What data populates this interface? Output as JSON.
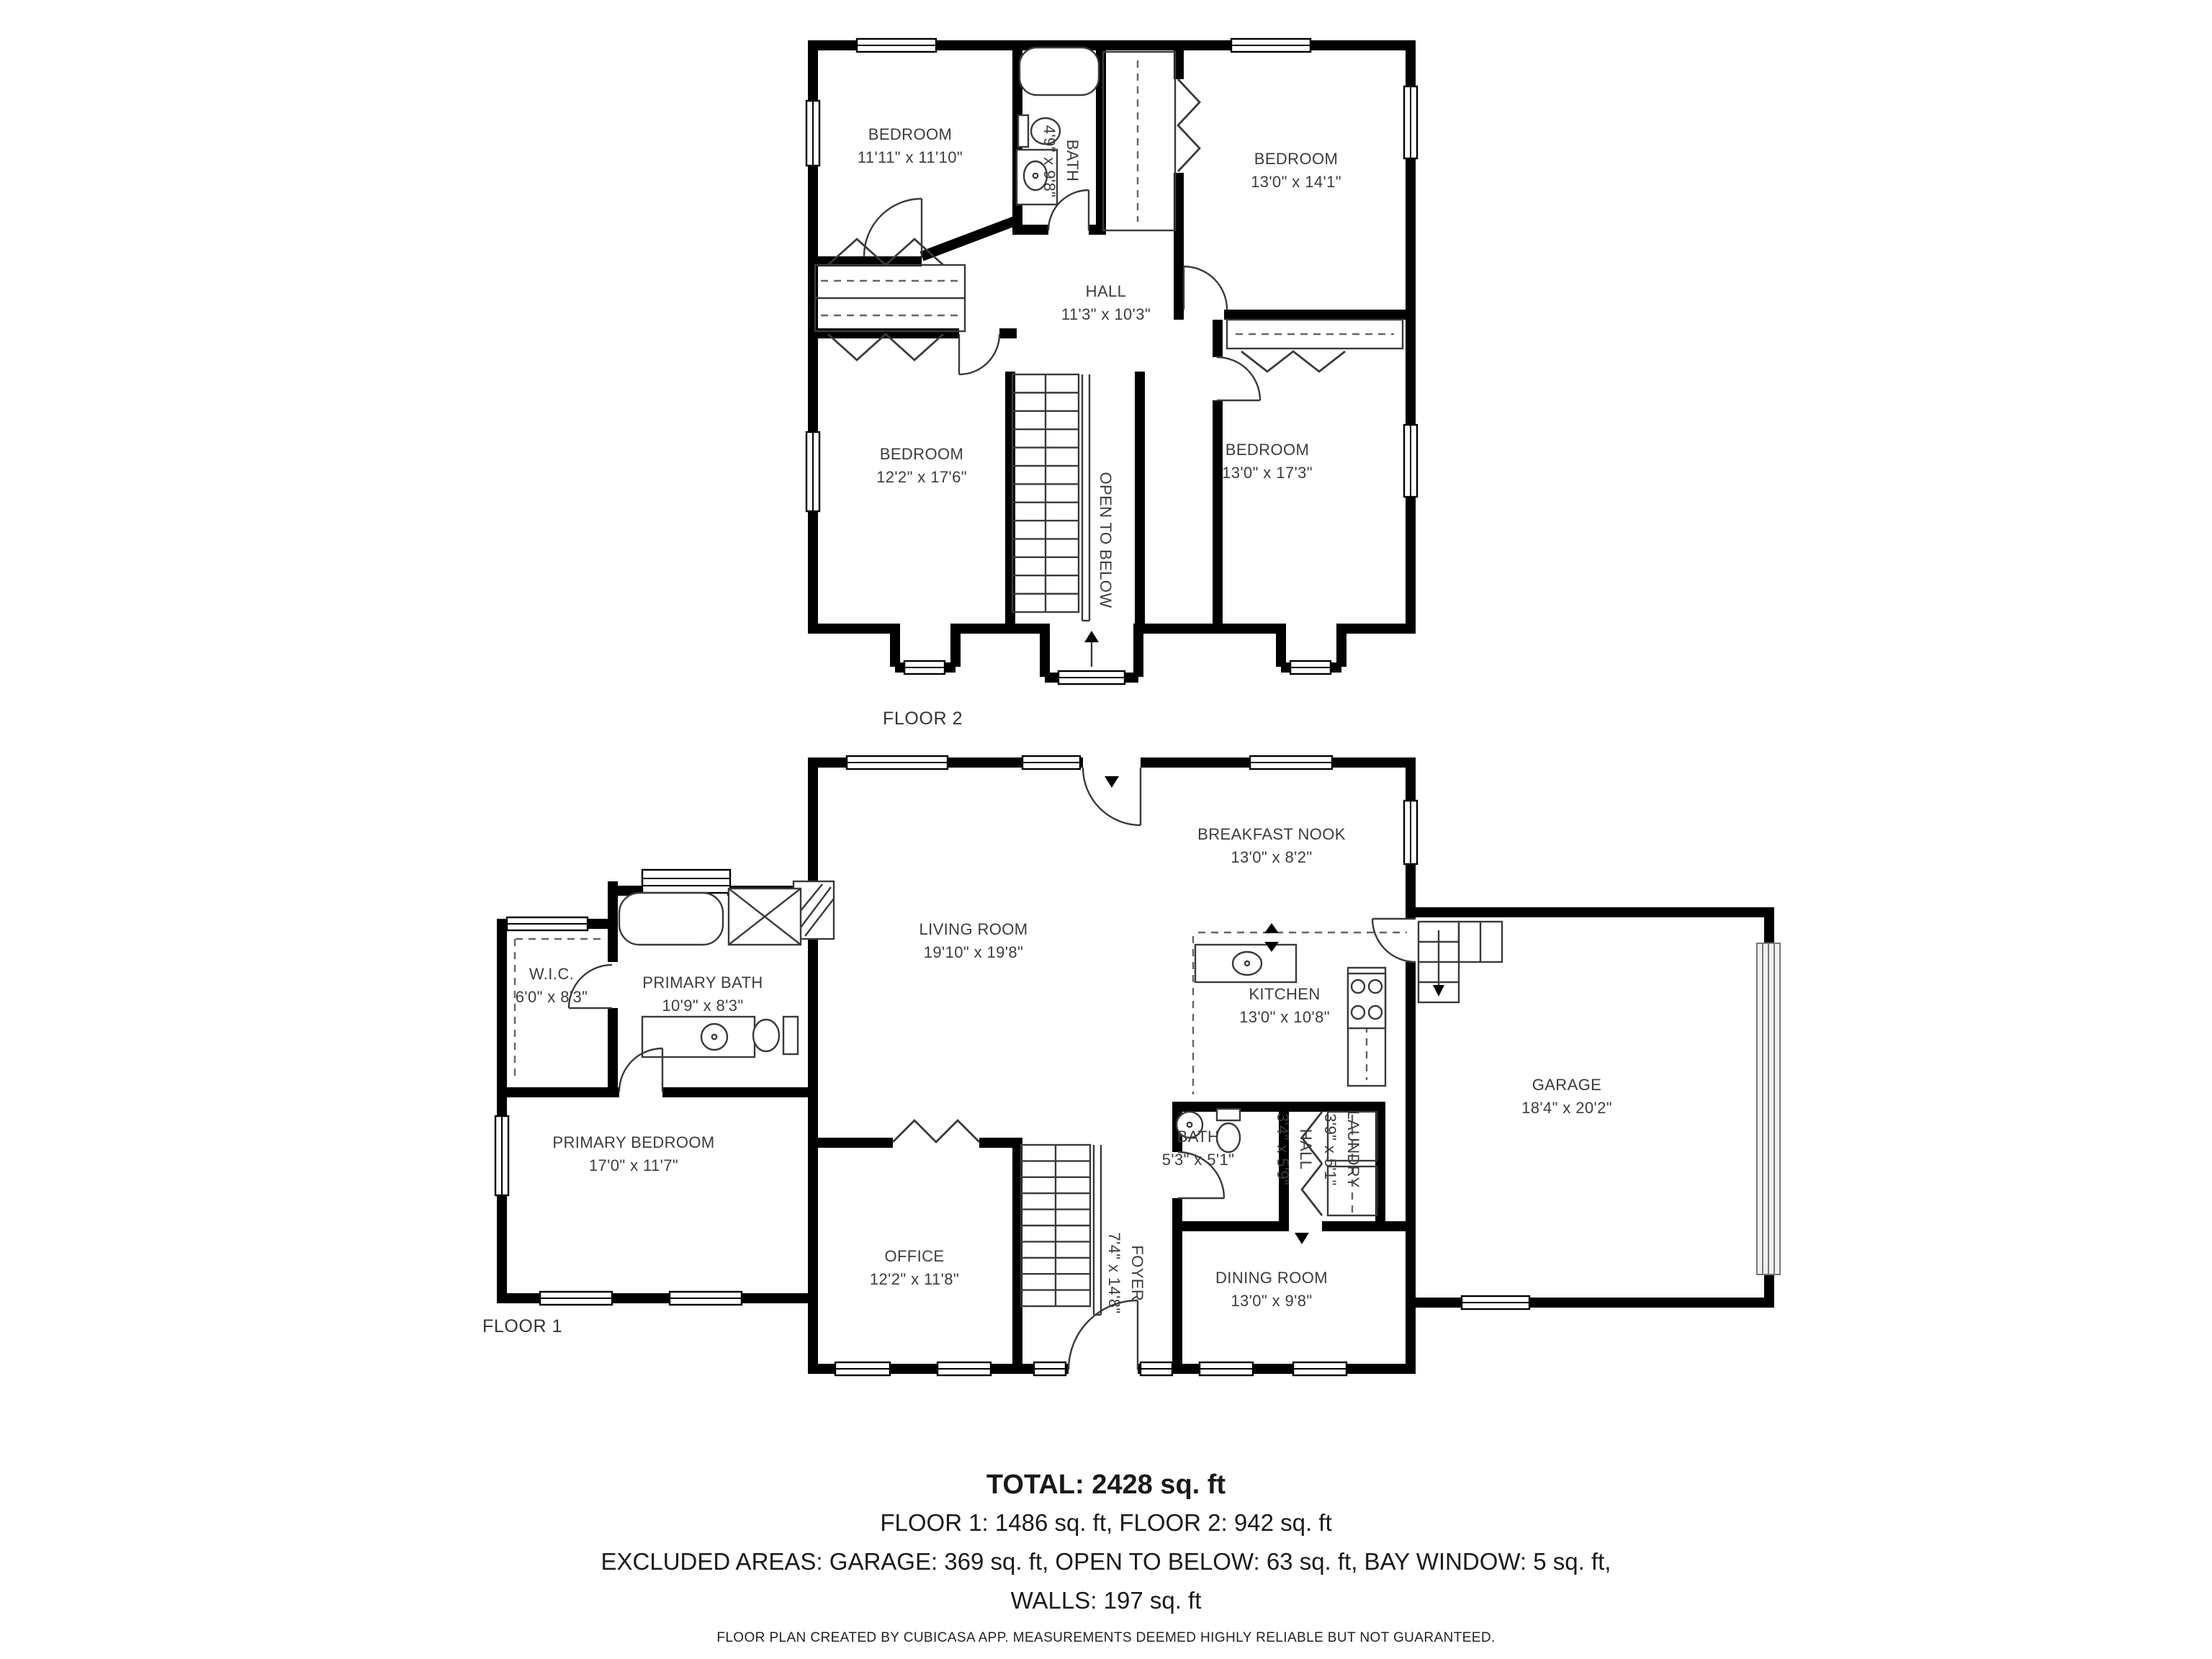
{
  "floor2": {
    "caption": "FLOOR 2",
    "rooms": {
      "bedroom_tl": {
        "name": "BEDROOM",
        "dims": "11'11\" x 11'10\""
      },
      "bath": {
        "name": "BATH",
        "dims": "4'9\" x 9'8\""
      },
      "bedroom_tr": {
        "name": "BEDROOM",
        "dims": "13'0\" x 14'1\""
      },
      "hall": {
        "name": "HALL",
        "dims": "11'3\" x 10'3\""
      },
      "bedroom_bl": {
        "name": "BEDROOM",
        "dims": "12'2\" x 17'6\""
      },
      "bedroom_br": {
        "name": "BEDROOM",
        "dims": "13'0\" x 17'3\""
      },
      "open_to_below": {
        "name": "OPEN TO BELOW"
      }
    }
  },
  "floor1": {
    "caption": "FLOOR 1",
    "rooms": {
      "breakfast_nook": {
        "name": "BREAKFAST NOOK",
        "dims": "13'0\" x 8'2\""
      },
      "living_room": {
        "name": "LIVING ROOM",
        "dims": "19'10\" x 19'8\""
      },
      "wic": {
        "name": "W.I.C.",
        "dims": "6'0\" x 8'3\""
      },
      "primary_bath": {
        "name": "PRIMARY BATH",
        "dims": "10'9\" x 8'3\""
      },
      "kitchen": {
        "name": "KITCHEN",
        "dims": "13'0\" x 10'8\""
      },
      "garage": {
        "name": "GARAGE",
        "dims": "18'4\" x 20'2\""
      },
      "primary_bedroom": {
        "name": "PRIMARY BEDROOM",
        "dims": "17'0\" x 11'7\""
      },
      "bath": {
        "name": "BATH",
        "dims": "5'3\" x 5'1\""
      },
      "hall": {
        "name": "HALL",
        "dims": "3'4\" x 5'9\""
      },
      "laundry": {
        "name": "LAUNDRY",
        "dims": "3'9\" x 5'1\""
      },
      "office": {
        "name": "OFFICE",
        "dims": "12'2\" x 11'8\""
      },
      "foyer": {
        "name": "FOYER",
        "dims": "7'4\" x 14'8\""
      },
      "dining_room": {
        "name": "DINING ROOM",
        "dims": "13'0\" x 9'8\""
      }
    }
  },
  "summary": {
    "total": "TOTAL: 2428 sq. ft",
    "floors": "FLOOR 1: 1486 sq. ft, FLOOR 2: 942 sq. ft",
    "excluded": "EXCLUDED AREAS: GARAGE: 369 sq. ft, OPEN TO BELOW: 63 sq. ft, BAY WINDOW: 5 sq. ft,",
    "walls": "WALLS: 197 sq. ft"
  },
  "footer": "FLOOR PLAN CREATED BY CUBICASA APP. MEASUREMENTS DEEMED HIGHLY RELIABLE BUT NOT GUARANTEED."
}
